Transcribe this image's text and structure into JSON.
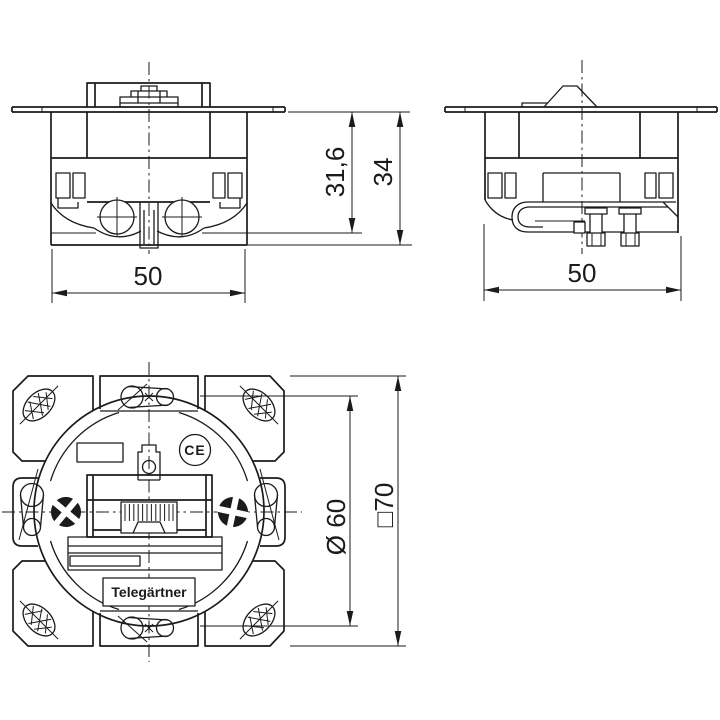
{
  "drawing": {
    "brand_label": "Telegärtner",
    "ce_mark": "CE",
    "dimensions": {
      "front_width": "50",
      "side_width": "50",
      "insert_depth": "31,6",
      "total_depth": "34",
      "body_diameter": "Ø 60",
      "frame_square": "□70"
    },
    "colors": {
      "line": "#1b1b1b",
      "background": "#ffffff"
    }
  }
}
